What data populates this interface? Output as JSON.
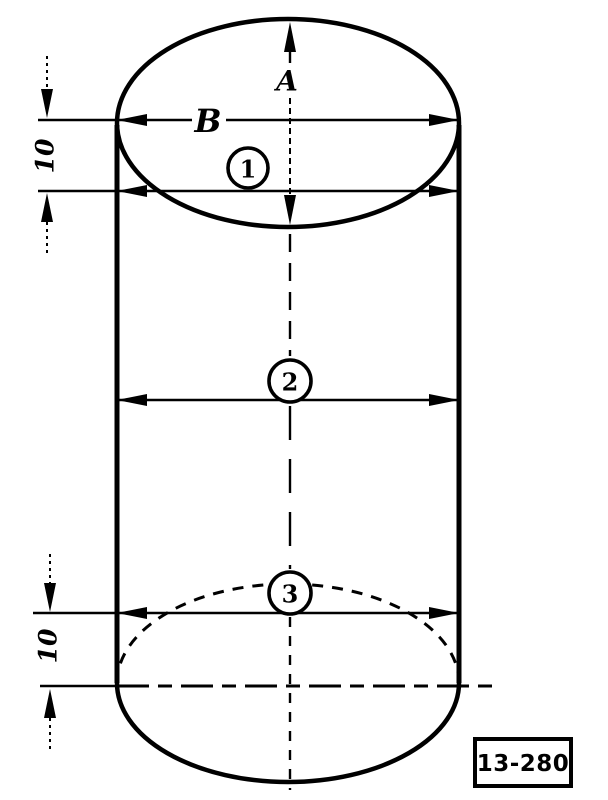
{
  "figure": {
    "paper_color": "#ffffff",
    "ink_color": "#000000",
    "dimensions": {
      "a_label": "A",
      "b_label": "B",
      "top_offset": "10",
      "bottom_offset": "10"
    },
    "callouts": [
      {
        "number": "1"
      },
      {
        "number": "2"
      },
      {
        "number": "3"
      }
    ],
    "figure_number": "13-280"
  }
}
